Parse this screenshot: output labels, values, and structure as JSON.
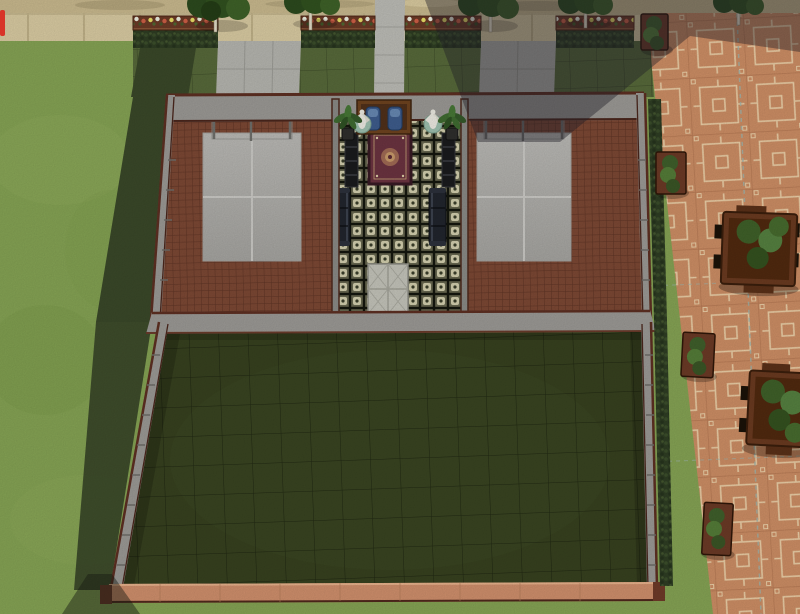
{
  "app": {
    "view_label": ""
  },
  "colors": {
    "grass-bright": "#85a354",
    "grass-garden": "#57693a",
    "grass-shadow": "#3a4829",
    "lawn-dark": "#37411f",
    "sand": "#c9b98e",
    "sidewalk": "#d9cba2",
    "concrete": "#b5b5af",
    "plaza-base": "#cd8e65",
    "plaza-line": "#ecd0a8",
    "brick": "#7c4834",
    "brick-line": "#5e3425",
    "wall-top": "#9b9995",
    "wall-edge": "#5d2f22",
    "hedge": "#2e3d23",
    "planter-wood": "#6b3a26",
    "court": "#b3b2ae",
    "hall-tile-dark": "#686850",
    "hall-tile-cream": "#d3cfae",
    "rug-field": "#6b3340",
    "rug-border": "#381a24",
    "sofa": "#21252d",
    "statue": "#eceae2",
    "statue-base": "#9dbfae",
    "cabinet-wood": "#6e431f",
    "cabinet-panel": "#3e5c8c",
    "lawn-wall-face": "#cf8f6c",
    "shadow": "rgba(35,33,42,0.42)",
    "ui-red": "#d83428"
  },
  "scene": {
    "objects": {
      "trees": 5,
      "flower_planter_rows": 4,
      "hedge_rows": 4,
      "concrete_paths": 3,
      "sport_courts": 2,
      "basketball_hoops": 2,
      "statues": 2,
      "potted_palms": 2,
      "benches": 2,
      "pedestal_columns": 2,
      "rug": 1,
      "wall_cabinet": 1,
      "door_mat": 1,
      "plaza_planter_boxes": 4,
      "plaza_planter_tables": 2
    }
  }
}
